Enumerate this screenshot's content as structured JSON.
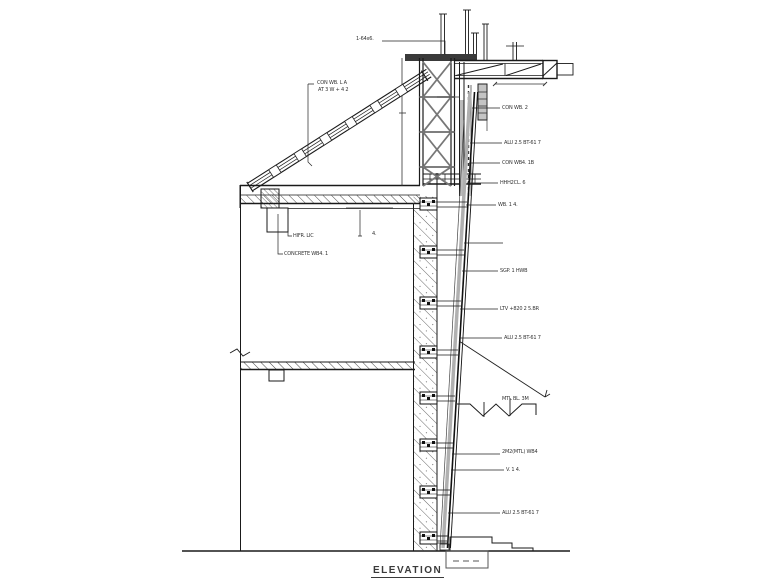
{
  "drawing": {
    "title": "ELEVATION",
    "labels": {
      "top_left": "1-64x6.",
      "brace_line1": "CON WB. L A",
      "brace_line2": "AT 3 W + 4 2",
      "beam_upper": "HIFR. LIC",
      "beam_lower": "CONCRETE WB4. 1",
      "slab_tick": "4.",
      "r1": "CON WB. 2",
      "r2": "ALU 2.5 BT-61 7",
      "r3": "CON WB4. 1B",
      "r4": "HHH2CL. 6",
      "r5": "WB. 1 4.",
      "r6": "SGP. 1 HWB",
      "r7": "LTV +820 2 5.BR",
      "r8": "ALU 2.5 BT-61 7",
      "r9": "MTL BL. 3M",
      "r10": "2M2(MTL) WB4",
      "r11": "V. 1 4.",
      "r12": "ALU 2.5 BT-61 7"
    },
    "colors": {
      "line": "#1a1a1a",
      "light_gray": "#b0b0b0",
      "label_text": "#333333"
    }
  }
}
